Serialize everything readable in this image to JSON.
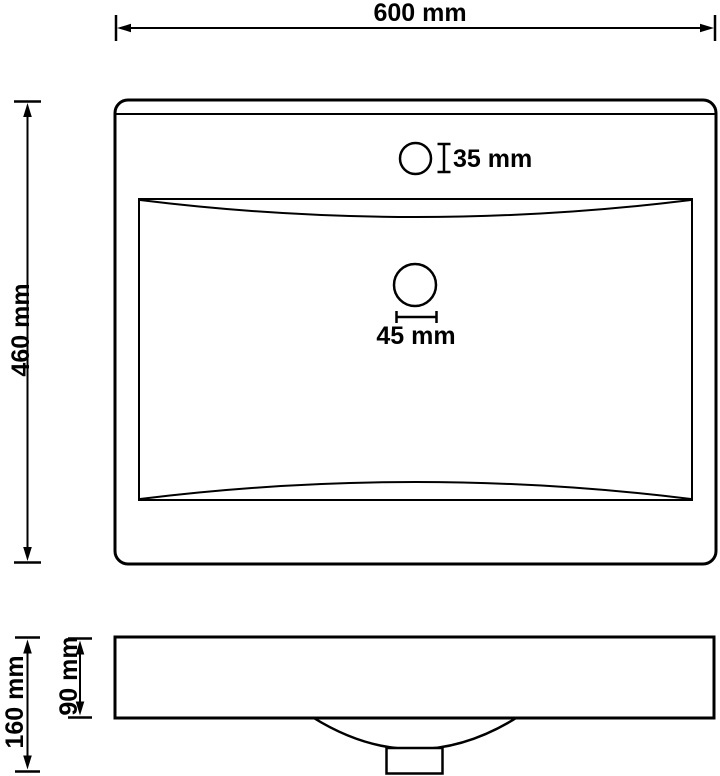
{
  "colors": {
    "line": "#000000",
    "background": "#ffffff"
  },
  "dimensions": {
    "overall_width": {
      "label": "600 mm"
    },
    "overall_depth": {
      "label": "460 mm"
    },
    "faucet_hole_diameter": {
      "label": "35 mm"
    },
    "drain_hole_diameter": {
      "label": "45 mm"
    },
    "rim_height": {
      "label": "90 mm"
    },
    "total_height": {
      "label": "160 mm"
    }
  }
}
